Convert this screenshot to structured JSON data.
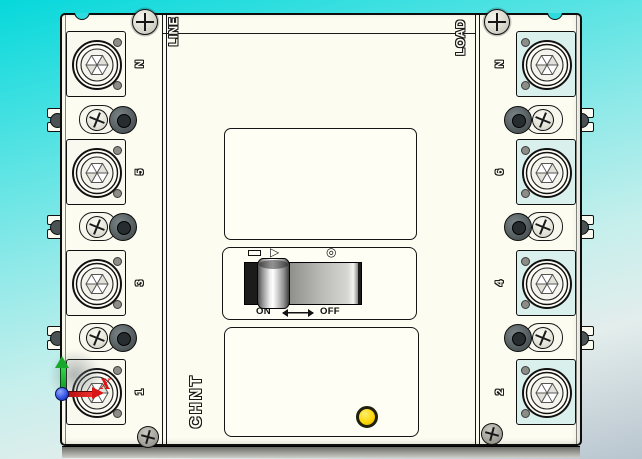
{
  "viewport": {
    "background_top_color": "#06d8db",
    "background_bottom_color": "#b9c5cf",
    "body_color": "#fcfcf1",
    "load_pad_tint": "#daf0ed"
  },
  "breaker": {
    "brand": "CHNT",
    "line_label": "LINE",
    "load_label": "LOAD",
    "left_terminals": [
      {
        "label": "N"
      },
      {
        "label": "5"
      },
      {
        "label": "3"
      },
      {
        "label": "1"
      }
    ],
    "right_terminals": [
      {
        "label": "N"
      },
      {
        "label": "6"
      },
      {
        "label": "4"
      },
      {
        "label": "2"
      }
    ],
    "switch": {
      "state": "ON",
      "on_label": "ON",
      "off_label": "OFF",
      "reset_symbol": "▷",
      "trip_symbol": "◎"
    },
    "indicator_color": "#ffd400"
  },
  "triad": {
    "x_label": "X",
    "x_color": "#d81414",
    "y_color": "#17a82b",
    "origin_color": "#2a49dd"
  }
}
